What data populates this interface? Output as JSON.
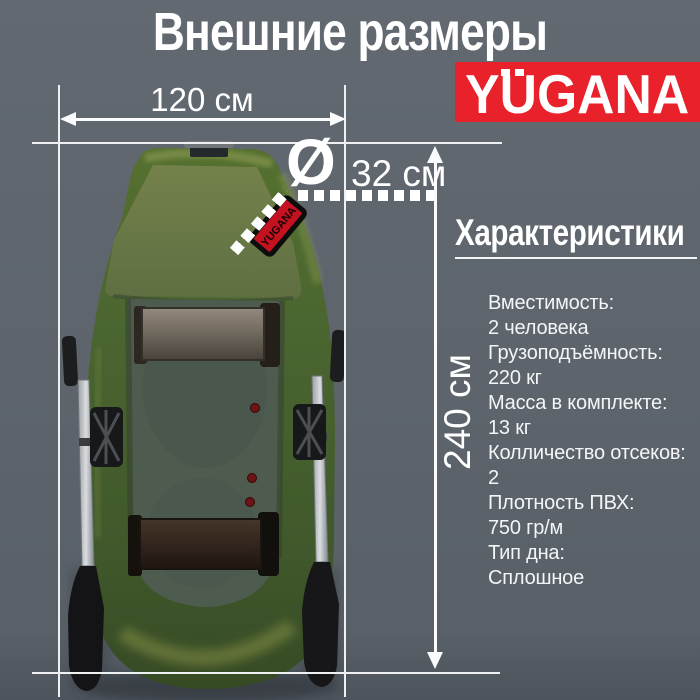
{
  "title": "Внешние размеры",
  "brand": {
    "logo_text": "YUGANA",
    "logo_bg": "#e8212b"
  },
  "dimensions": {
    "width_label": "120 см",
    "diameter_symbol": "Ø",
    "diameter_label": "32 см",
    "length_label": "240 см"
  },
  "specs": {
    "heading": "Характеристики",
    "items": [
      {
        "label": "Вместимость:",
        "value": "2 человека"
      },
      {
        "label": "Грузоподъёмность:",
        "value": "220 кг"
      },
      {
        "label": "Масса в комплекте:",
        "value": "13 кг"
      },
      {
        "label": "Колличество отсеков:",
        "value": "2"
      },
      {
        "label": "Плотность ПВХ:",
        "value": "750 гр/м"
      },
      {
        "label": "Тип дна:",
        "value": "Сплошное"
      }
    ]
  },
  "boat": {
    "patch_text": "YUGANA",
    "hull_color": "#4c6733"
  },
  "colors": {
    "background": "#5d646c",
    "accent_red": "#e8212b",
    "annotation_white": "#f2f4f6"
  }
}
